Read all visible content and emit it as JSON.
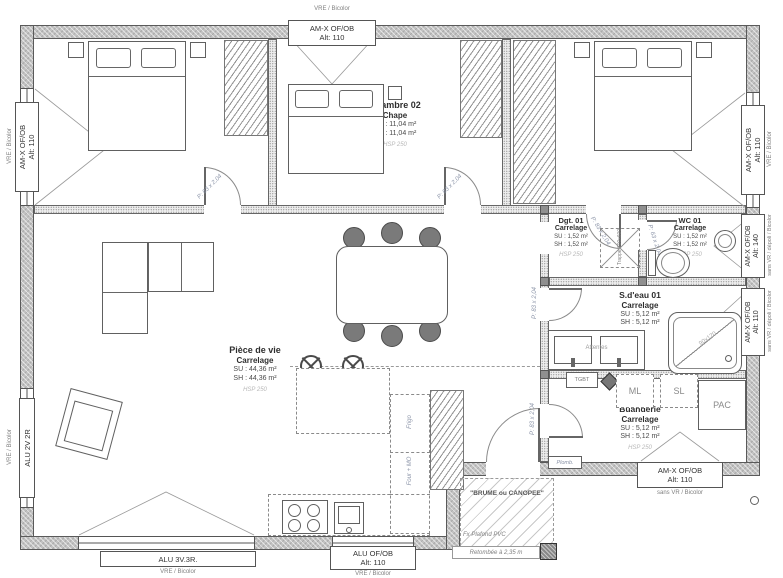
{
  "rooms": {
    "chambre01": {
      "name": "Chambre 01",
      "finish": "Chape",
      "su": "SU : 11,04 m²",
      "sh": "SH : 11,04 m²",
      "hsp": "HSP 250"
    },
    "chambre02": {
      "name": "Chambre 02",
      "finish": "Chape",
      "su": "SU : 11,04 m²",
      "sh": "SH : 11,04 m²",
      "hsp": "HSP 250"
    },
    "chambre03": {
      "name": "Chambre 03",
      "finish": "Chape",
      "su": "SU : 11,32 m²",
      "sh": "SH : 11,32 m²",
      "hsp": "HSP 250"
    },
    "dgt01": {
      "name": "Dgt. 01",
      "finish": "Carrelage",
      "su": "SU : 1,52 m²",
      "sh": "SH : 1,52 m²",
      "hsp": "HSP 250"
    },
    "wc01": {
      "name": "WC 01",
      "finish": "Carrelage",
      "su": "SU : 1,52 m²",
      "sh": "SH : 1,52 m²",
      "hsp": "HSP 250"
    },
    "sdeau01": {
      "name": "S.d'eau 01",
      "finish": "Carrelage",
      "su": "SU : 5,12 m²",
      "sh": "SH : 5,12 m²"
    },
    "buanderie": {
      "name": "Buanderie",
      "finish": "Carrelage",
      "su": "SU : 5,12 m²",
      "sh": "SH : 5,12 m²",
      "hsp": "HSP 250"
    },
    "piece_de_vie": {
      "name": "Pièce de vie",
      "finish": "Carrelage",
      "su": "SU : 44,36 m²",
      "sh": "SH : 44,36 m²",
      "hsp": "HSP 250"
    }
  },
  "windows": {
    "top": {
      "name": "AM-X OF/OB",
      "alt": "Alt: 110",
      "note": "VRE / Bicolor"
    },
    "left_ch01": {
      "name": "AM-X OF/OB",
      "alt": "Alt: 110",
      "note": "VRE / Bicolor"
    },
    "left_living": {
      "name": "ALU 2V 2R",
      "note": "VRE / Bicolor"
    },
    "right_ch03": {
      "name": "AM-X OF/OB",
      "alt": "Alt: 110",
      "note": "VRE / Bicolor"
    },
    "right_wc": {
      "name": "AM-X OF/OB",
      "alt": "Alt: 140",
      "note": "sans VR / dépoli / Bicolor"
    },
    "right_sdeau": {
      "name": "AM-X OF/OB",
      "alt": "Alt: 110",
      "note": "sans VR / dépoli / Bicolor"
    },
    "bottom_living": {
      "name": "ALU 3V.3R.",
      "note": "VRE / Bicolor"
    },
    "bottom_kitchen": {
      "name": "ALU OF/OB",
      "alt": "Alt: 110",
      "note": "VRE / Bicolor"
    },
    "bottom_buanderie": {
      "name": "AM-X OF/OB",
      "alt": "Alt: 110",
      "note": "sans VR / Bicolor"
    }
  },
  "doors": {
    "ch01": "P: 83 x 2,04",
    "ch02": "P: 83 x 2,04",
    "ch03": "P: 83 x 2,04",
    "wc": "P: 63 x 2,04",
    "sdeau": "P: 83 x 2,04",
    "buanderie": "P: 83 x 2,04"
  },
  "kitchen": {
    "fridge": "Frigo",
    "oven": "Four + MO"
  },
  "equipment": {
    "tgbt": "TGBT",
    "washer": "ML",
    "dryer": "SL",
    "heat_pump": "PAC",
    "plumbing": "Plomb.",
    "fixtures_waiting": "Attentes",
    "shower_size": "90x120",
    "ceiling_hatch": "Trappe 600x600"
  },
  "terrace": {
    "title": "\"BRUME ou CANOPEE\"",
    "ceiling": "Fx Plafond PVC",
    "drop": "Retombée à 2,35 m"
  },
  "colors": {
    "wall": "#c2c2c2",
    "partition": "#ececec",
    "line": "#555555",
    "door_label": "#8b94a8",
    "muted": "#b8b8b8"
  }
}
